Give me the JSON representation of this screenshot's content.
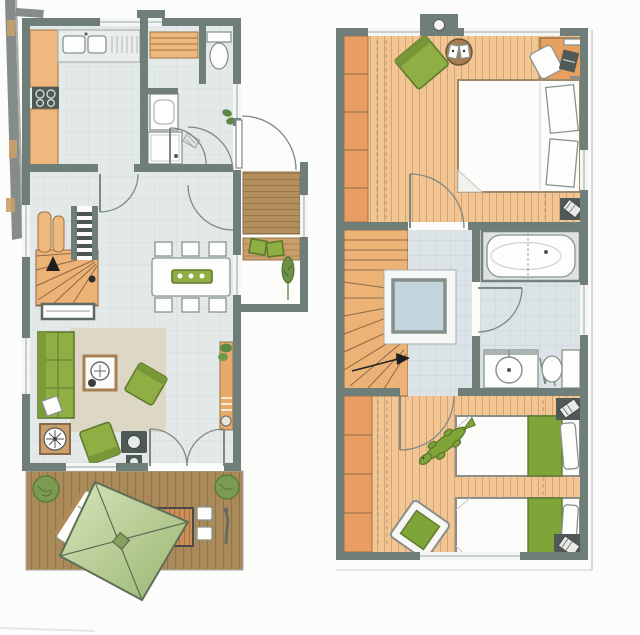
{
  "document": {
    "type": "architectural-floor-plan",
    "description": "Scanned colour floor plan of a two-storey holiday house: ground floor with terrace on the left, upper floor on the right. No text labels are printed on the drawing.",
    "floors": [
      "ground-floor",
      "upper-floor"
    ]
  },
  "colors": {
    "page": "#fcfcfb",
    "wall": "#6f7e79",
    "floorTile": "#e3e8e8",
    "tileUpper": "#dbe3e6",
    "woodPlank": "#f2c694",
    "woodPlankLine": "#d9a26b",
    "kneeWall": "#e99d63",
    "stairWood": "#edb275",
    "counterWood": "#efb87e",
    "deck": "#a98a58",
    "deckLine": "#8f7448",
    "porchDeck": "#b3905e",
    "porchDeckLine": "#97764b",
    "furnitureGreen": "#8fae43",
    "furnitureGreenDark": "#5e7a2f",
    "blanketGreen": "#7fa438",
    "rug": "#ddd8c5",
    "white": "#fdfdfc",
    "glass": "#c3d5dc",
    "applianceDark": "#4f5a57",
    "bush": "#7a9b50",
    "parasolLight": "#d8e5bc",
    "parasolDark": "#98b56f",
    "tan": "#c9a06b"
  },
  "ground_floor": {
    "label": "Ground floor",
    "rooms": [
      {
        "name": "kitchen",
        "furniture": [
          "double-sink",
          "drainer",
          "cooktop",
          "wood-counters"
        ]
      },
      {
        "name": "bathroom",
        "furniture": [
          "sauna-bench",
          "toilet",
          "washbasin",
          "washing-machine",
          "bath-mat"
        ]
      },
      {
        "name": "hall",
        "furniture": [
          "winder-staircase",
          "two-wardrobes",
          "sideboard",
          "entrance-plant"
        ]
      },
      {
        "name": "dining-area",
        "furniture": [
          "dining-table",
          "six-chairs",
          "table-runner"
        ]
      },
      {
        "name": "living-room",
        "furniture": [
          "sofa",
          "rug",
          "coffee-table",
          "two-armchairs",
          "wood-stove",
          "pellet-stove",
          "shelf-with-plant"
        ]
      },
      {
        "name": "entrance-porch",
        "furniture": [
          "entry-deck",
          "bench-with-cushions",
          "tree"
        ]
      },
      {
        "name": "terrace",
        "furniture": [
          "wood-deck",
          "square-parasol",
          "sun-lounger",
          "outdoor-table",
          "four-outdoor-chairs",
          "two-shrubs",
          "garden-sculpture"
        ]
      }
    ]
  },
  "upper_floor": {
    "label": "Upper floor",
    "rooms": [
      {
        "name": "master-bedroom",
        "furniture": [
          "double-bed",
          "two-pillows",
          "green-armchair",
          "round-side-table-with-books",
          "desk",
          "desk-chair",
          "laptop",
          "knee-wall-storage",
          "roof-window-chimney"
        ]
      },
      {
        "name": "landing",
        "furniture": [
          "winder-staircase",
          "glass-shower"
        ]
      },
      {
        "name": "bathroom",
        "furniture": [
          "bathtub",
          "washbasin",
          "toilet",
          "towel-rail"
        ]
      },
      {
        "name": "kids-bedroom",
        "furniture": [
          "two-single-beds",
          "green-blankets",
          "armchair-with-green-cushion",
          "crocodile-toy",
          "knee-wall-storage",
          "corner-units"
        ]
      }
    ]
  }
}
